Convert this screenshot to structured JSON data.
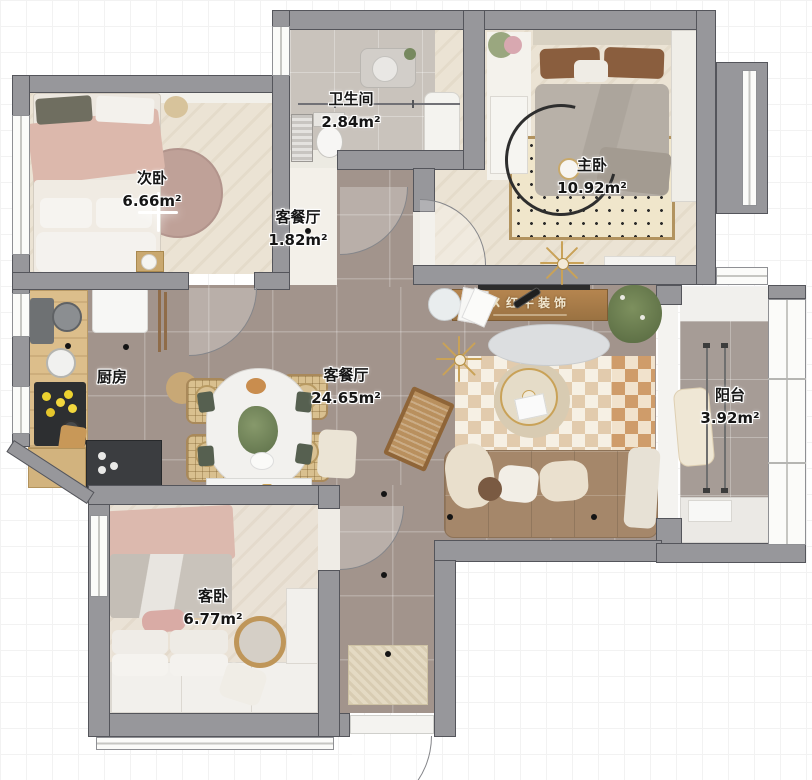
{
  "plan": {
    "rooms": [
      {
        "id": "ciwo",
        "name": "次卧",
        "area": "6.66m²"
      },
      {
        "id": "weishengjian",
        "name": "卫生间",
        "area": "2.84m²"
      },
      {
        "id": "zhuwo",
        "name": "主卧",
        "area": "10.92m²"
      },
      {
        "id": "hallway",
        "name": "客餐厅",
        "area": "1.82m²"
      },
      {
        "id": "chufang",
        "name": "厨房",
        "area": ""
      },
      {
        "id": "kecanting",
        "name": "客餐厅",
        "area": "24.65m²"
      },
      {
        "id": "yangtai",
        "name": "阳台",
        "area": "3.92m²"
      },
      {
        "id": "kewo",
        "name": "客卧",
        "area": "6.77m²"
      }
    ],
    "brand": {
      "logo_text": "红牛装饰"
    },
    "colors": {
      "wall": "#97979b",
      "wall_outline": "#54555b",
      "wood_floor": "#ebe3d4",
      "tile_floor": "#a2948c",
      "bath_floor": "#c9c3bc",
      "accent_gold": "#c9a258",
      "rug_mauve": "#bfa198",
      "sofa": "#a5876a",
      "checker_tan": "#e2cbad",
      "cabinet_wood": "#dcbe8b",
      "counter_dark": "#3b3d40"
    }
  }
}
